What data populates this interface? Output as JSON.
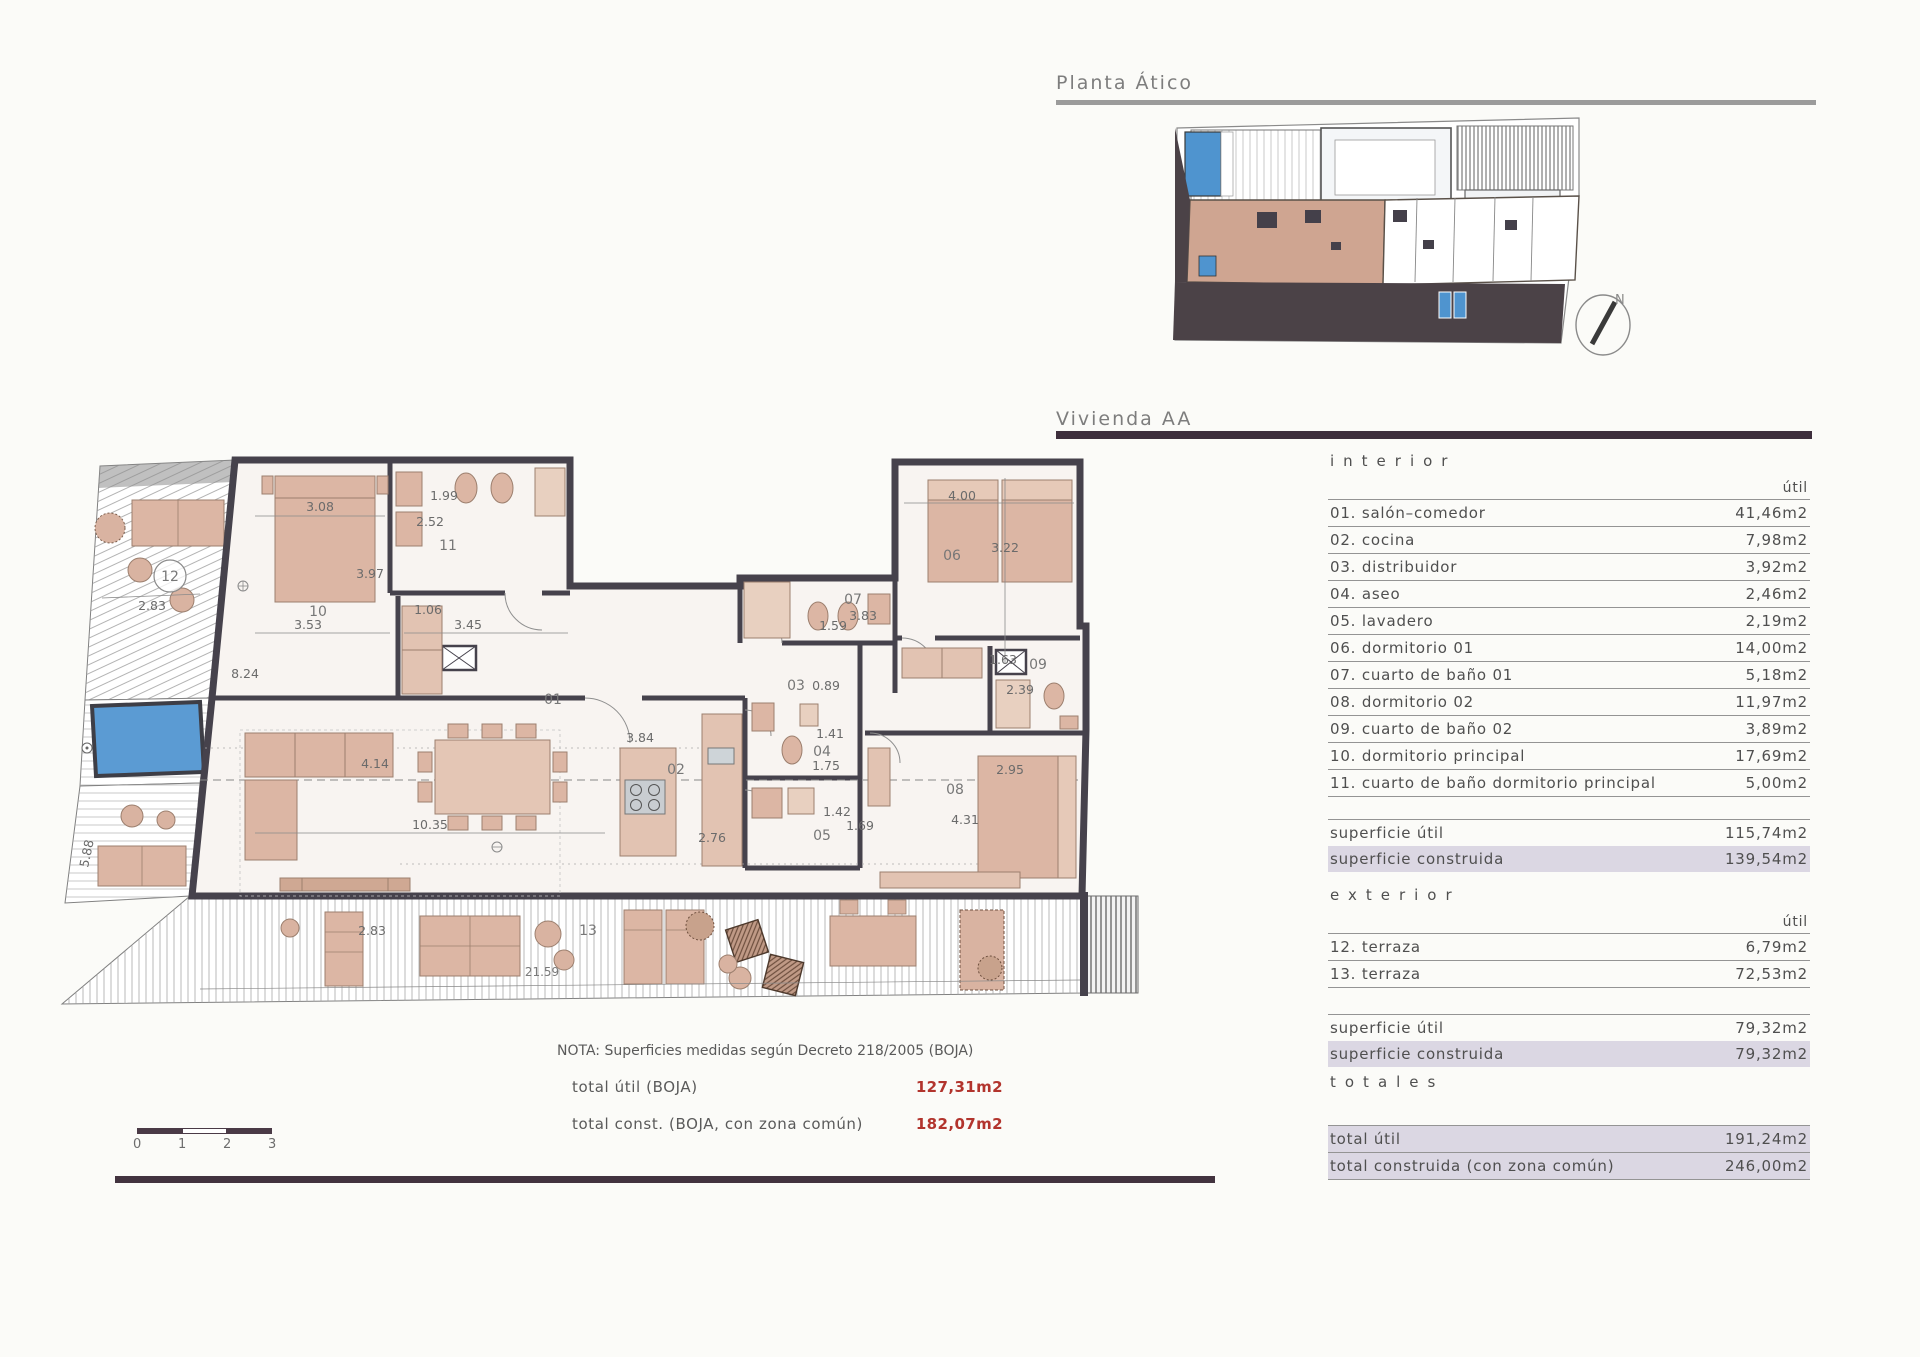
{
  "page": {
    "planta_title": "Planta Ático",
    "vivienda_title": "Vivienda AA",
    "north_label": "N"
  },
  "table": {
    "interior_header": "interior",
    "exterior_header": "exterior",
    "totales_header": "totales",
    "util_header_1": "útil",
    "util_header_2": "útil",
    "rows_interior": [
      {
        "label": "01. salón–comedor",
        "value": "41,46m2"
      },
      {
        "label": "02. cocina",
        "value": "7,98m2"
      },
      {
        "label": "03. distribuidor",
        "value": "3,92m2"
      },
      {
        "label": "04. aseo",
        "value": "2,46m2"
      },
      {
        "label": "05. lavadero",
        "value": "2,19m2"
      },
      {
        "label": "06. dormitorio 01",
        "value": "14,00m2"
      },
      {
        "label": "07. cuarto de baño 01",
        "value": "5,18m2"
      },
      {
        "label": "08. dormitorio 02",
        "value": "11,97m2"
      },
      {
        "label": "09. cuarto de baño 02",
        "value": "3,89m2"
      },
      {
        "label": "10. dormitorio principal",
        "value": "17,69m2"
      },
      {
        "label": "11. cuarto de baño dormitorio principal",
        "value": "5,00m2"
      }
    ],
    "interior_summary": [
      {
        "label": "superficie útil",
        "value": "115,74m2"
      },
      {
        "label": "superficie construida",
        "value": "139,54m2"
      }
    ],
    "rows_exterior": [
      {
        "label": "12. terraza",
        "value": "6,79m2"
      },
      {
        "label": "13. terraza",
        "value": "72,53m2"
      }
    ],
    "exterior_summary": [
      {
        "label": "superficie útil",
        "value": "79,32m2"
      },
      {
        "label": "superficie construida",
        "value": "79,32m2"
      }
    ],
    "totals": [
      {
        "label": "total útil",
        "value": "191,24m2"
      },
      {
        "label": "total construida (con zona común)",
        "value": "246,00m2"
      }
    ]
  },
  "note": {
    "text": "NOTA: Superficies medidas según Decreto 218/2005 (BOJA)",
    "rows": [
      {
        "label": "total útil (BOJA)",
        "value": "127,31m2"
      },
      {
        "label": "total const. (BOJA, con zona común)",
        "value": "182,07m2"
      }
    ]
  },
  "scalebar": {
    "l0": "0",
    "l1": "1",
    "l2": "2",
    "l3": "3"
  },
  "floorplan": {
    "rooms": {
      "r01": "01",
      "r02": "02",
      "r03": "03",
      "r04": "04",
      "r05": "05",
      "r06": "06",
      "r07": "07",
      "r08": "08",
      "r09": "09",
      "r10": "10",
      "r11": "11",
      "r12": "12",
      "r13": "13"
    },
    "dims": {
      "d308": "3.08",
      "d199": "1.99",
      "d252": "2.52",
      "d397": "3.97",
      "d106": "1.06",
      "d353": "3.53",
      "d345": "3.45",
      "d824": "8.24",
      "d414": "4.14",
      "d1035": "10.35",
      "d276": "2.76",
      "d384": "3.84",
      "d089": "0.89",
      "d141": "1.41",
      "d175": "1.75",
      "d142": "1.42",
      "d169": "1.69",
      "d400": "4.00",
      "d322": "3.22",
      "d383": "3.83",
      "d159": "1.59",
      "d163": "1.63",
      "d239": "2.39",
      "d295": "2.95",
      "d431": "4.31",
      "d283a": "2.83",
      "d283b": "2.83",
      "d588": "5.88",
      "d2159": "21.59"
    }
  }
}
